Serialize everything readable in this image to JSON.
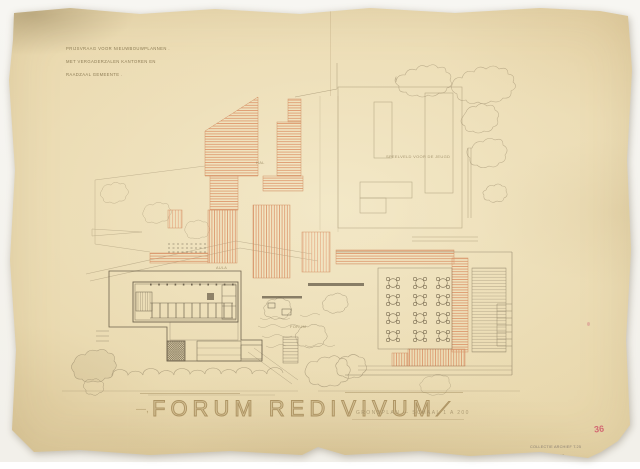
{
  "document": {
    "title": "FORUM REDIVIVUM",
    "title_prefix": "—,",
    "title_suffix": "⟋",
    "subtitle": "GRONDPLAN — SCHAAL 1 A 200"
  },
  "header_annotation": {
    "line1": "PRIJSVRAAG VOOR NIEUWBOUWPLANNEN .",
    "line2": "MET VERGADERZALEN KANTOREN EN",
    "line3": "RAADZAAL GEMEENTE ."
  },
  "plan_labels": {
    "field": "SPEELVELD VOOR DE JEUGD",
    "hall": "HAL",
    "aula": "AULA",
    "forum": "FORUM"
  },
  "stamp": {
    "line1": "COLLECTIE ARCHIEF T.25",
    "line2": "MAP FORUM A 62",
    "line3": "BLAD 7 PLAN",
    "red_mark": "36"
  },
  "colors": {
    "paper": "#e9dbb3",
    "background": "#f6f5f1",
    "roof_hatch_orange": "#dc9368",
    "pencil": "#6d6049",
    "dark_pencil": "#4f4433",
    "title_brown": "#a48960",
    "stamp_red": "#cf4f66"
  }
}
